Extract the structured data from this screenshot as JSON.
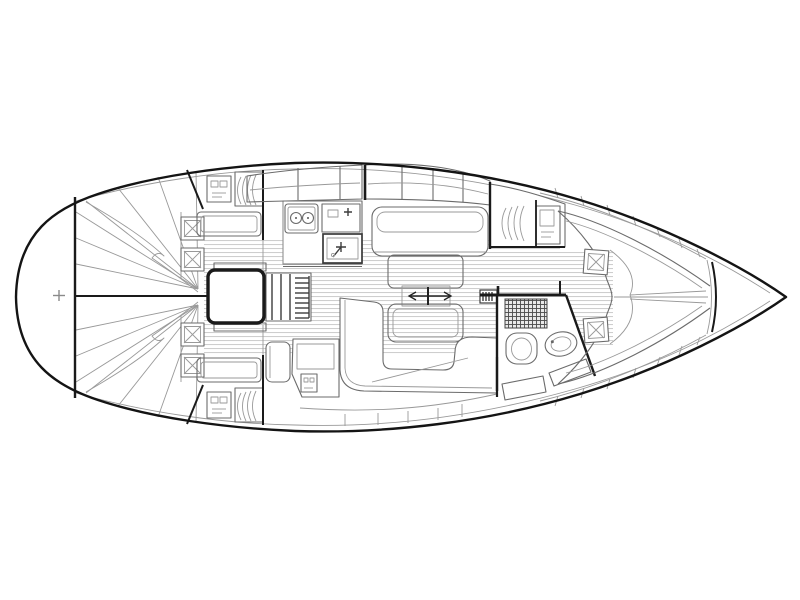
{
  "diagram": {
    "label": "Sailing yacht interior layout floor plan, top view, bow pointing right",
    "type": "yacht-floor-plan",
    "orientation": "bow-right"
  },
  "colors": {
    "hull": "#141414",
    "walls": "#1a1a1a",
    "furniture": "#6b6b6b",
    "detail": "#999999",
    "floor_stripe": "#c6c6c6",
    "background": "#ffffff"
  },
  "components": [
    "hull-outline",
    "transom-bulkhead",
    "stern-centerline",
    "stern-fitting-mark",
    "aft-cabin-starboard",
    "aft-cabin-port",
    "aft-berth-fan",
    "pillow",
    "hanging-locker",
    "wardrobe-cabinet",
    "companionway-engine-box",
    "companionway-steps",
    "sliding-hatch",
    "galley-counter",
    "stove-two-burner",
    "sink-with-faucet",
    "overhead-locker-band",
    "cabin-sole-floorboards",
    "salon-settee-starboard",
    "salon-settee-u-shaped",
    "salon-table",
    "mast-position-marker",
    "keel-bolt-box",
    "nav-station-desk",
    "nav-seat",
    "head-compartment",
    "shower-grate",
    "toilet",
    "washbasin",
    "forward-hanging-locker",
    "v-berth",
    "anchor-locker-bulkhead",
    "hull-shelf-lockers"
  ]
}
